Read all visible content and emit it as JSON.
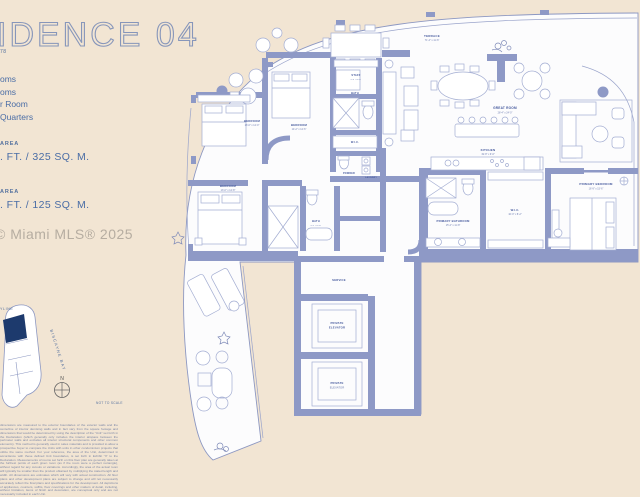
{
  "page": {
    "background": "#f2e5d3",
    "wall_color": "#8e99c6",
    "line_color": "#9aa4cb",
    "label_color": "#44589c",
    "text_color": "#4a6da6",
    "navy": "#1d3a6d"
  },
  "header": {
    "title_fragment": "IDENCE 04",
    "subtitle_fragment": "78"
  },
  "features": {
    "items": [
      "oms",
      "oms",
      "r Room",
      "Quarters"
    ]
  },
  "areas": {
    "interior_label": "AREA",
    "interior_value": ". FT. / 325 SQ. M.",
    "exterior_label": "AREA",
    "exterior_value": ". FT. / 125 SQ. M."
  },
  "watermark": "© Miami MLS® 2025",
  "keyplan": {
    "street_fragment": "YLINE",
    "bay_label": "BISCAYNE BAY",
    "compass_label": "N",
    "scale_note": "NOT TO SCALE"
  },
  "floorplan": {
    "rooms": {
      "terrace": {
        "name": "TERRACE",
        "dims": "71'-4\" x 11'-6\""
      },
      "great_room": {
        "name": "GREAT ROOM",
        "dims": "28'-4\" x 24'-0\""
      },
      "kitchen": {
        "name": "KITCHEN",
        "dims": "19'-8\" x 9'-6\""
      },
      "primary_bedroom": {
        "name": "PRIMARY BEDROOM",
        "dims": "16'-9\" x 15'-6\""
      },
      "primary_bathroom": {
        "name": "PRIMARY BATHROOM",
        "dims": "15'-2\" x 11'-8\""
      },
      "primary_wic": {
        "name": "W.I.C.",
        "dims": "10'-0\" x 8'-2\""
      },
      "bedroom_2": {
        "name": "BEDROOM",
        "dims": "13'-6\" x 12'-0\""
      },
      "bedroom_3": {
        "name": "BEDROOM",
        "dims": "14'-2\" x 12'-6\""
      },
      "bedroom_4": {
        "name": "BEDROOM",
        "dims": "13'-0\" x 12'-8\""
      },
      "bath_2": {
        "name": "BATH",
        "dims": "9'-2\" x 5'-6\""
      },
      "bath_3": {
        "name": "BATH",
        "dims": "9'-0\" x 5'-8\""
      },
      "wic_2": {
        "name": "W.I.C."
      },
      "powder": {
        "name": "POWDER"
      },
      "laundry": {
        "name": "LAUNDRY"
      },
      "staff": {
        "name": "STAFF",
        "dims": "9'-0\" x 8'-6\""
      },
      "service": {
        "name": "SERVICE"
      },
      "elevator_1": {
        "line1": "PRIVATE",
        "line2": "ELEVATOR"
      },
      "elevator_2": {
        "line1": "PRIVATE",
        "line2": "ELEVATOR"
      }
    }
  },
  "disclaimer": "dimensions are measured to the exterior boundaries of the exterior walls and the centerline of interior demising walls and in fact vary from the square footage and dimensions that would be determined by using the description of the \"Unit\" set forth in the Declaration (which generally only includes the interior airspace between the perimeter walls and excludes all interior structural components and other common elements). This method is generally used in sales materials and is provided to allow a prospective buyer to compare the Units with units in other condominium projects that utilize the same method. For your reference, the area of the Unit, determined in accordance with these defined Unit boundaries, is set forth in Exhibit \"3\" to the Declaration. Measurements of rooms set forth on this floor plan are generally taken at the furthest points of each given room (as if the room were a perfect rectangle), without regard for any cutouts or variations. Accordingly, the area of the actual room will typically be smaller than the product obtained by multiplying the stated length and width. All dimensions are estimates which will vary with actual construction. All floor plans and other development plans are subject to change and will not necessarily accurately reflect the final plans and specifications for the development. All depictions of appliances, counters, soffits, floor coverings and other matters of detail, including, without limitation, items of finish and decoration, are conceptual only and are not necessarily included in each Unit."
}
